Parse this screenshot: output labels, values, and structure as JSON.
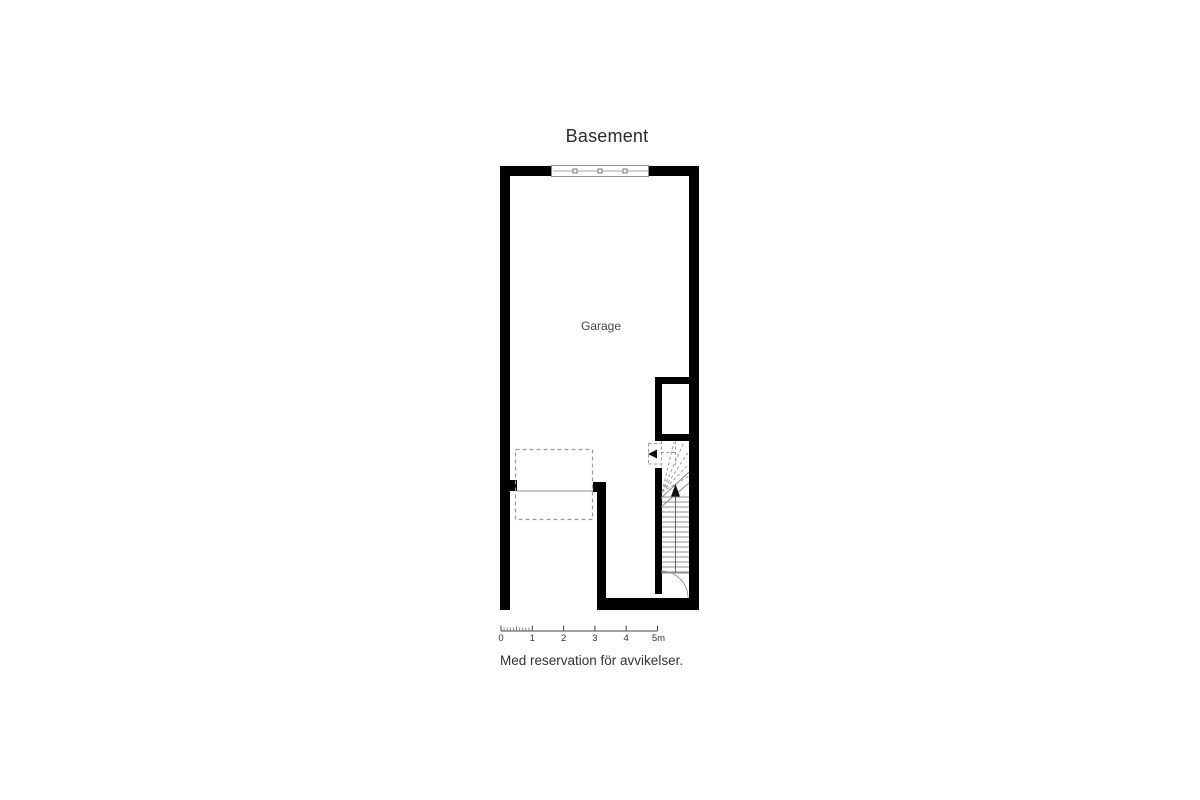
{
  "floor_plan": {
    "title": "Basement",
    "room_labels": {
      "garage": "Garage"
    },
    "disclaimer": "Med reservation för avvikelser.",
    "scale_bar": {
      "unit": "m",
      "length_meters": 5,
      "tick_labels": [
        "0",
        "1",
        "2",
        "3",
        "4",
        "5m"
      ]
    },
    "symbols": {
      "garage_door": "sectional-garage-door",
      "stair_up_arrow": "stairs-up-direction",
      "stair_exit_arrow": "stairs-exit-left",
      "swing_door": "quarter-arc-door"
    },
    "colors": {
      "wall": "#000000",
      "dashed_line": "#9b9b9b",
      "stair_line": "#8c8c8c",
      "text_primary": "#2b2b2b",
      "text_secondary": "#474747"
    }
  }
}
